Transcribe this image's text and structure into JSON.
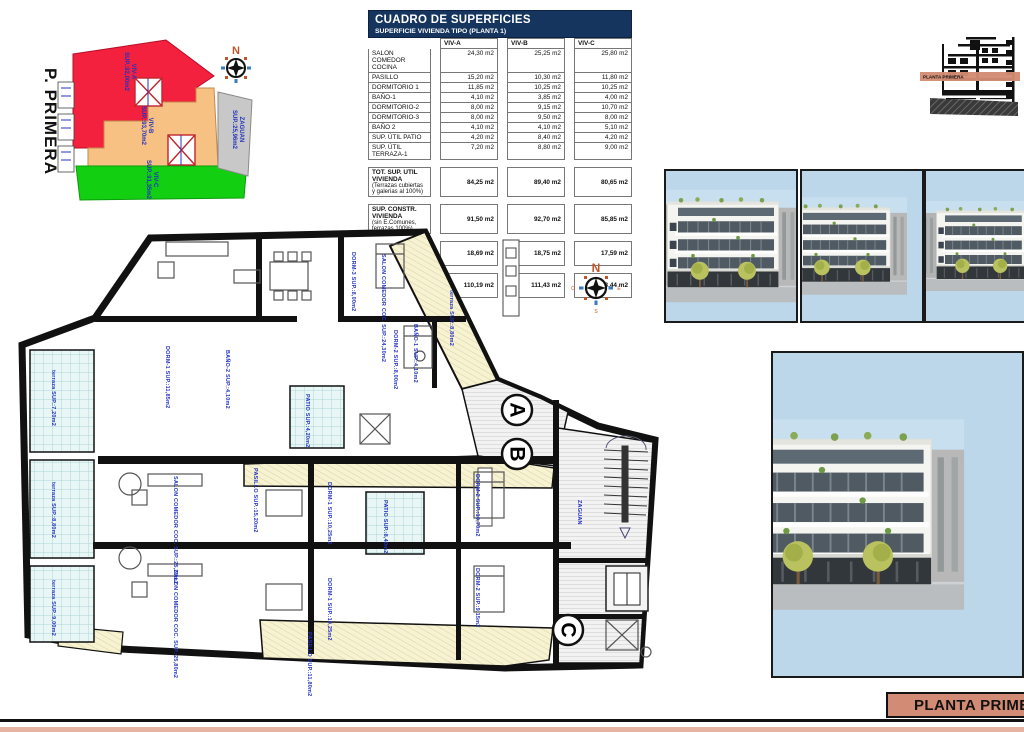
{
  "sheet": {
    "accent_color": "#d28b74",
    "header_color": "#16355e",
    "label_blue": "#2333c0"
  },
  "compass": {
    "n": "N",
    "e": "E",
    "s": "S",
    "o": "O"
  },
  "keyplan": {
    "title": "P. PRIMERA",
    "regions": [
      {
        "label": "VIV-A",
        "sup": "SUP.:92,00m2",
        "color": "#f3203e"
      },
      {
        "label": "VIV-B",
        "sup": "SUP.:93,70m2",
        "color": "#f6c183"
      },
      {
        "label": "VIV-C",
        "sup": "SUP.:91,35m2",
        "color": "#12cf12"
      },
      {
        "label": "ZAGUAN",
        "sup": "SUP.:25,96m2",
        "color": "#c8c8c8"
      }
    ]
  },
  "table": {
    "title": "CUADRO DE SUPERFICIES",
    "subtitle": "SUPERFICIE VIVIENDA TIPO  (PLANTA 1)",
    "columns": [
      "VIV-A",
      "VIV-B",
      "VIV-C"
    ],
    "rows": [
      {
        "label": "SALON COMEDOR COCINA",
        "a": "24,30 m2",
        "b": "25,25 m2",
        "c": "25,80 m2"
      },
      {
        "label": "PASILLO",
        "a": "15,20 m2",
        "b": "10,30 m2",
        "c": "11,80 m2"
      },
      {
        "label": "DORMITORIO 1",
        "a": "11,85 m2",
        "b": "10,25 m2",
        "c": "10,25 m2"
      },
      {
        "label": "BAÑO-1",
        "a": "4,10 m2",
        "b": "3,85 m2",
        "c": "4,00 m2"
      },
      {
        "label": "DORMITORIO-2",
        "a": "8,00 m2",
        "b": "9,15 m2",
        "c": "10,70 m2"
      },
      {
        "label": "DORMITORIO-3",
        "a": "8,00 m2",
        "b": "9,50 m2",
        "c": "8,00 m2"
      },
      {
        "label": "BAÑO 2",
        "a": "4,10 m2",
        "b": "4,10 m2",
        "c": "5,10 m2"
      },
      {
        "label": "SUP. ÚTIL PATIO",
        "a": "4,20 m2",
        "b": "8,40 m2",
        "c": "4,20 m2"
      },
      {
        "label": "SUP. ÚTIL TERRAZA-1",
        "a": "7,20 m2",
        "b": "8,80 m2",
        "c": "9,00 m2"
      }
    ],
    "summary": [
      {
        "label": "TOT. SUP. UTIL VIVIENDA",
        "sub": "(Terrazas cubiertas y galerias al 100%)",
        "a": "84,25 m2",
        "b": "89,40 m2",
        "c": "80,65 m2"
      },
      {
        "label": "SUP. CONSTR. VIVIENDA",
        "sub": "(sin E.Comunes, terrazas 100%)",
        "a": "91,50 m2",
        "b": "92,70 m2",
        "c": "85,85 m2"
      },
      {
        "label": "SUP. CONSTRUIDA COMUNES",
        "sub": "",
        "a": "18,69 m2",
        "b": "18,75 m2",
        "c": "17,59 m2"
      },
      {
        "label": "SUPERFICIE CONSTRUIDA TOTAL",
        "sub": "",
        "a": "110,19 m2",
        "b": "111,43 m2",
        "c": "103,44 m2"
      }
    ]
  },
  "section": {
    "band_label": "PLANTA PRIMERA"
  },
  "floorplan": {
    "title": "P. PRIMERA",
    "unit_markers": [
      "A",
      "B",
      "C"
    ],
    "labels": [
      {
        "text": "SALON COMEDOR COC. SUP.:24,30m2"
      },
      {
        "text": "DORM-3 SUP.:8,00m2"
      },
      {
        "text": "BAÑO-1 SUP.:4,10m2"
      },
      {
        "text": "DORM-2 SUP.:8,00m2"
      },
      {
        "text": "DORM-1 SUP.:11,85m2"
      },
      {
        "text": "BAÑO-2 SUP.:4,10m2"
      },
      {
        "text": "PASILLO SUP.:15,20m2"
      },
      {
        "text": "terraza SUP.:7,20m2"
      },
      {
        "text": "terraza SUP.:8,80m2"
      },
      {
        "text": "terraza SUP.:9,00m2"
      },
      {
        "text": "PATIO SUP.:4,20m2"
      },
      {
        "text": "PATIO SUP.:8,40m2"
      },
      {
        "text": "SALON COMEDOR COC. SUP.:25,25m2"
      },
      {
        "text": "SALON COMEDOR COC. SUP.:25,80m2"
      },
      {
        "text": "DORM-1 SUP.:10,25m2"
      },
      {
        "text": "DORM-1 SUP.:10,25m2"
      },
      {
        "text": "DORM-2 SUP.:10,70m2"
      },
      {
        "text": "DORM-2 SUP.:9,15m2"
      },
      {
        "text": "ZAGUAN"
      },
      {
        "text": "PASILLO SUP.:11,80m2"
      },
      {
        "text": "terraza SUP.:8,80m2"
      }
    ]
  },
  "titleblock": {
    "text": "PLANTA PRIMERA"
  }
}
